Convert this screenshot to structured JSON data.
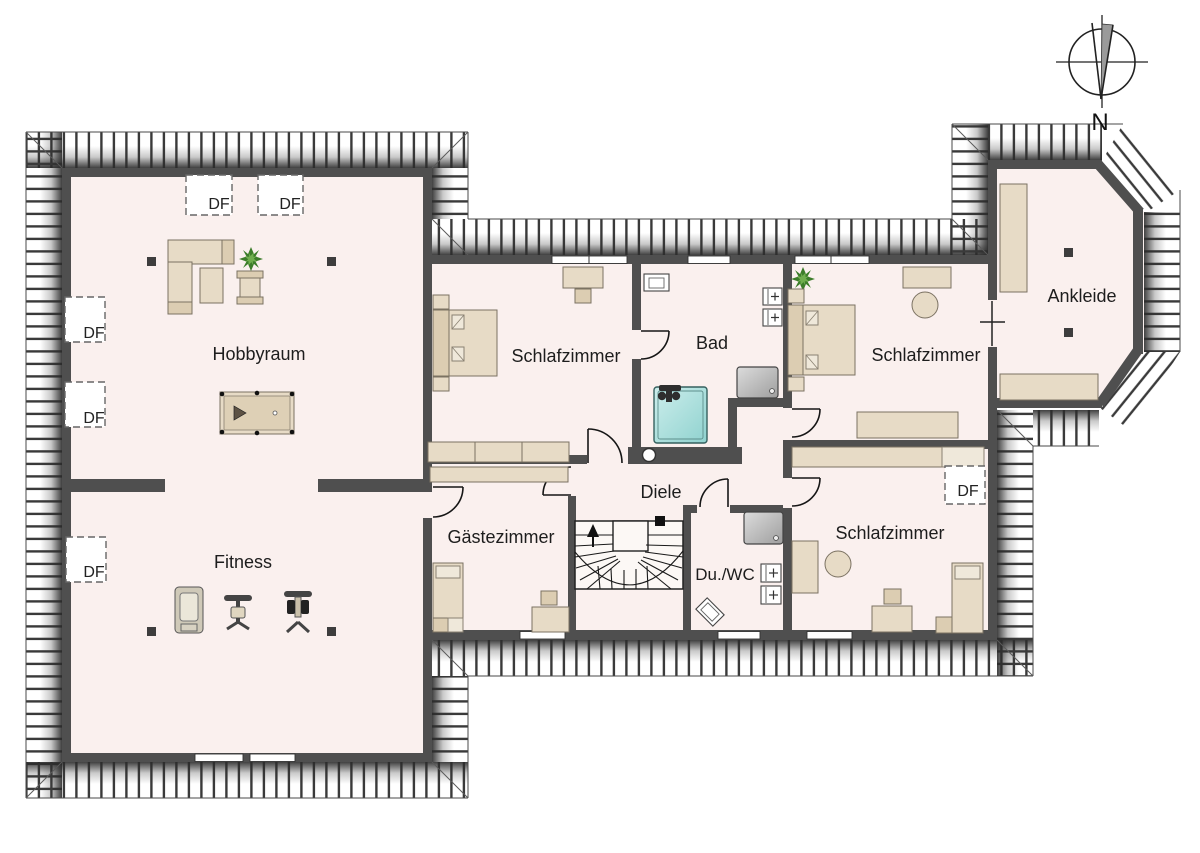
{
  "plan": {
    "compass_label": "N",
    "roof_window_label": "DF",
    "rooms": {
      "hobbyraum": "Hobbyraum",
      "fitness": "Fitness",
      "schlafzimmer_links": "Schlafzimmer",
      "bad": "Bad",
      "diele": "Diele",
      "gaestezimmer": "Gästezimmer",
      "du_wc": "Du./WC",
      "schlafzimmer_oben_rechts": "Schlafzimmer",
      "schlafzimmer_unten_rechts": "Schlafzimmer",
      "ankleide": "Ankleide"
    },
    "colors": {
      "floor": "#faf0ee",
      "wall": "#4f4f4f",
      "furniture": "#e7dbc6",
      "bathtub": "#a5ddda",
      "shower": "#bfbfbf",
      "plant_green": "#3c7d2a"
    }
  }
}
